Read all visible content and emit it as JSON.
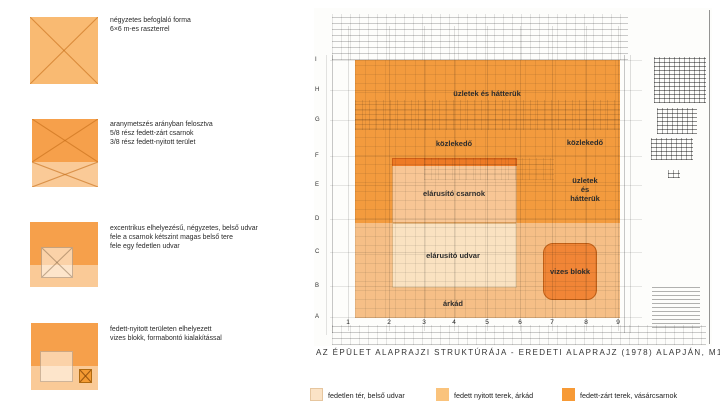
{
  "palette": {
    "dark_orange": "#f59c3f",
    "medium_orange": "#f8c189",
    "light_cream": "#fbe3c6",
    "x_line": "#c46c18"
  },
  "concepts": [
    {
      "lines": [
        "négyzetes befoglaló forma",
        "6×6 m-es raszterrel"
      ]
    },
    {
      "lines": [
        "aranymetszés arányban felosztva",
        "5/8 rész fedett-zárt csarnok",
        "3/8 rész fedett-nyitott terület"
      ]
    },
    {
      "lines": [
        "excentrikus elhelyezésű, négyzetes, belső udvar",
        "fele a csarnok kétszint magas belső tere",
        "fele egy fedetlen udvar"
      ]
    },
    {
      "lines": [
        "fedett-nyitott területen elhelyezett",
        "vizes blokk, formabontó kialakítással"
      ]
    }
  ],
  "plan": {
    "labels": {
      "shops_top": "üzletek és hátterük",
      "circulation_left": "közlekedő",
      "circulation_right": "közlekedő",
      "hall": "elárusító csarnok",
      "shops_right": [
        "üzletek",
        "és",
        "hátterük"
      ],
      "courtyard": "elárusító udvar",
      "wet_block": "vizes blokk",
      "arcade": "árkád"
    },
    "grid_rows": [
      "I",
      "H",
      "G",
      "F",
      "E",
      "D",
      "C",
      "B",
      "A"
    ],
    "grid_cols": [
      "1",
      "2",
      "3",
      "4",
      "5",
      "6",
      "7",
      "8",
      "9"
    ]
  },
  "caption": "AZ ÉPÜLET ALAPRAJZI STRUKTÚRÁJA - EREDETI ALAPRAJZ (1978) ALAPJÁN, M1:500",
  "legend": [
    {
      "label": "fedetlen tér, belső udvar",
      "color": "#fbe3c6"
    },
    {
      "label": "fedett nyitott terek, árkád",
      "color": "#fac37c"
    },
    {
      "label": "fedett-zárt terek, vásárcsarnok",
      "color": "#f79a36"
    }
  ]
}
